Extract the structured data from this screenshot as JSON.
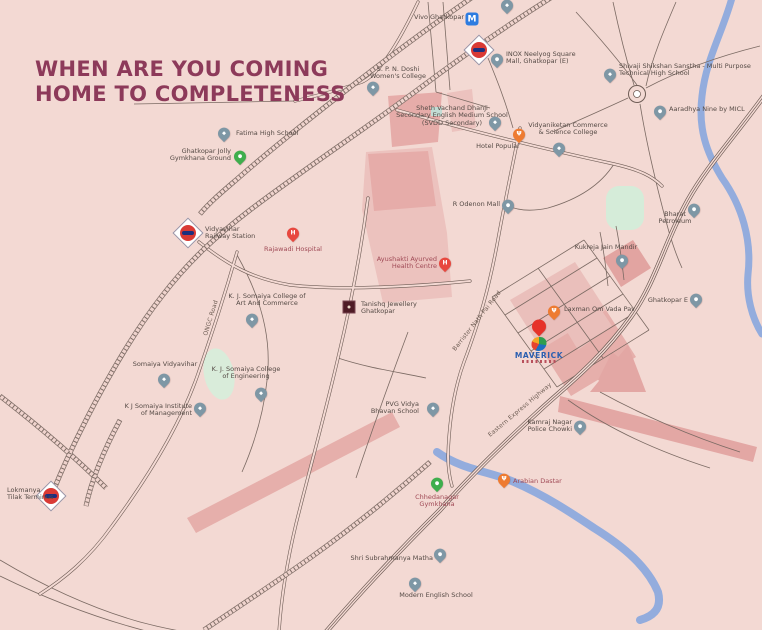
{
  "page": {
    "headline_line1": "WHEN ARE YOU COMING",
    "headline_line2": "HOME TO COMPLETENESS"
  },
  "colors": {
    "background": "#f3d9d3",
    "headline": "#8d3a5a",
    "road": "#6e5c55",
    "river": "#93acdd",
    "pink_block": "#ecc2be",
    "pink_block_dark": "#e6aca9",
    "green_area": "#d6ecd9",
    "pin_slate": "#7e97a5",
    "pin_green": "#3fae4d",
    "pin_orange": "#ee7b31",
    "pin_red": "#e8483f",
    "metro_blue": "#2e7ce0",
    "maverick_blue": "#2a5fb0",
    "label": "#554a45",
    "label_maroon": "#a04a56"
  },
  "map": {
    "glyphs": {
      "hospital": "H",
      "metro": "M"
    },
    "road_labels": [
      {
        "id": "ongc-road",
        "text": "ONGC Road",
        "x": 211,
        "y": 318,
        "rotate": -73
      },
      {
        "id": "barrister-nath-pai-road",
        "text": "Barrister Nath Pai Road",
        "x": 477,
        "y": 321,
        "rotate": -52
      },
      {
        "id": "eastern-express-highway",
        "text": "Eastern Express Highway",
        "x": 520,
        "y": 410,
        "rotate": -40
      }
    ],
    "locations": [
      {
        "id": "jhunjhunwala-college",
        "type": "school",
        "x": 507,
        "y": 14,
        "lines": [
          "Jhunjhunwala College"
        ],
        "label": {
          "x": 470,
          "y": -7,
          "anchor": "c"
        }
      },
      {
        "id": "vivo-ghatkopar-metro",
        "type": "metro",
        "x": 472,
        "y": 19,
        "lines": [
          "Vivo Ghatkopar"
        ],
        "label": {
          "x": 464,
          "y": 14,
          "anchor": "r"
        }
      },
      {
        "id": "ghatkopar-railway-station",
        "type": "rail",
        "x": 479,
        "y": 50,
        "lines": [],
        "label": null
      },
      {
        "id": "inox-neelyog-square-mall",
        "type": "mall",
        "x": 497,
        "y": 68,
        "lines": [
          "INOX Neelyog Square",
          "Mall, Ghatkopar (E)"
        ],
        "label": {
          "x": 506,
          "y": 51,
          "anchor": "l"
        }
      },
      {
        "id": "spn-doshi-womens-college",
        "type": "school",
        "x": 373,
        "y": 96,
        "lines": [
          "S. P. N. Doshi",
          "Women's College"
        ],
        "label": {
          "x": 398,
          "y": 66,
          "anchor": "c"
        }
      },
      {
        "id": "fatima-high-school",
        "type": "school",
        "x": 224,
        "y": 142,
        "lines": [
          "Fatima High School"
        ],
        "label": {
          "x": 236,
          "y": 130,
          "anchor": "l"
        }
      },
      {
        "id": "ghatkopar-jolly-gymkhana-ground",
        "type": "green",
        "x": 240,
        "y": 165,
        "lines": [
          "Ghatkopar Jolly",
          "Gymkhana Ground"
        ],
        "label": {
          "x": 231,
          "y": 148,
          "anchor": "r"
        }
      },
      {
        "id": "vidyavihar-railway-station",
        "type": "rail",
        "x": 188,
        "y": 233,
        "lines": [
          "Vidyavihar",
          "Railway Station"
        ],
        "label": {
          "x": 205,
          "y": 226,
          "anchor": "l"
        }
      },
      {
        "id": "rajawadi-hospital",
        "type": "hospital",
        "x": 293,
        "y": 242,
        "lines": [
          "Rajawadi Hospital"
        ],
        "label": {
          "x": 293,
          "y": 246,
          "anchor": "c",
          "color": "maroon"
        }
      },
      {
        "id": "kj-somaiya-art-commerce",
        "type": "school",
        "x": 252,
        "y": 328,
        "lines": [
          "K. J. Somaiya College of",
          "Art And Commerce"
        ],
        "label": {
          "x": 267,
          "y": 293,
          "anchor": "c"
        }
      },
      {
        "id": "tanishq-jewellery-ghatkopar",
        "type": "tanishq",
        "x": 349,
        "y": 307,
        "lines": [
          "Tanishq Jewellery",
          "Ghatkopar"
        ],
        "label": {
          "x": 361,
          "y": 301,
          "anchor": "l"
        }
      },
      {
        "id": "ayushakti-ayurved-health-centre",
        "type": "hospital",
        "x": 445,
        "y": 272,
        "lines": [
          "Ayushakti Ayurved",
          "Health Centre"
        ],
        "label": {
          "x": 437,
          "y": 256,
          "anchor": "r",
          "color": "maroon"
        }
      },
      {
        "id": "hotel-popular",
        "type": "food",
        "x": 519,
        "y": 143,
        "lines": [
          "Hotel Popular"
        ],
        "label": {
          "x": 498,
          "y": 143,
          "anchor": "c"
        }
      },
      {
        "id": "sheth-svdd-school",
        "type": "school",
        "x": 495,
        "y": 131,
        "lines": [
          "Sheth Vachand Dhanji",
          "Secondary English Medium School",
          "(SVDD Secondary)"
        ],
        "label": {
          "x": 452,
          "y": 105,
          "anchor": "c"
        }
      },
      {
        "id": "vidyaniketan-college",
        "type": "school",
        "x": 559,
        "y": 157,
        "lines": [
          "Vidyaniketan Commerce",
          "& Science College"
        ],
        "label": {
          "x": 568,
          "y": 122,
          "anchor": "c"
        }
      },
      {
        "id": "shivaji-shikshan-sanstha",
        "type": "school",
        "x": 610,
        "y": 83,
        "lines": [
          "Shivaji Shikshan Sanstha - Multi Purpose",
          "Technical High School"
        ],
        "label": {
          "x": 619,
          "y": 63,
          "anchor": "l"
        }
      },
      {
        "id": "aaradhya-nine-by-micl",
        "type": "place",
        "x": 660,
        "y": 120,
        "lines": [
          "Aaradhya Nine by MICL"
        ],
        "label": {
          "x": 669,
          "y": 106,
          "anchor": "l"
        }
      },
      {
        "id": "r-odenon-mall",
        "type": "mall",
        "x": 508,
        "y": 214,
        "lines": [
          "R Odenon Mall"
        ],
        "label": {
          "x": 500,
          "y": 201,
          "anchor": "r"
        }
      },
      {
        "id": "bharat-petroleum",
        "type": "fuel",
        "x": 694,
        "y": 218,
        "lines": [
          "Bharat",
          "Petroleum"
        ],
        "label": {
          "x": 675,
          "y": 211,
          "anchor": "c"
        }
      },
      {
        "id": "kukreja-jain-mandir",
        "type": "place",
        "x": 622,
        "y": 269,
        "lines": [
          "Kukreja Jain Mandir"
        ],
        "label": {
          "x": 606,
          "y": 244,
          "anchor": "c"
        }
      },
      {
        "id": "ghatkopar-e",
        "type": "place",
        "x": 696,
        "y": 308,
        "lines": [
          "Ghatkopar E"
        ],
        "label": {
          "x": 688,
          "y": 297,
          "anchor": "r"
        }
      },
      {
        "id": "laxman-om-vada-pav",
        "type": "food",
        "x": 554,
        "y": 320,
        "lines": [
          "Laxman Om Vada Pav"
        ],
        "label": {
          "x": 564,
          "y": 306,
          "anchor": "l"
        }
      },
      {
        "id": "maverick-site",
        "type": "maverick",
        "x": 539,
        "y": 336,
        "lines": [
          "MAVERICK"
        ],
        "label": null
      },
      {
        "id": "pvg-vidya-bhavan-school",
        "type": "school",
        "x": 433,
        "y": 417,
        "lines": [
          "PVG Vidya",
          "Bhavan School"
        ],
        "label": {
          "x": 419,
          "y": 401,
          "anchor": "r"
        }
      },
      {
        "id": "kamraj-nagar-police-chowki",
        "type": "police",
        "x": 580,
        "y": 435,
        "lines": [
          "Kamraj Nagar",
          "Police Chowki"
        ],
        "label": {
          "x": 572,
          "y": 419,
          "anchor": "r"
        }
      },
      {
        "id": "arabian-dastar",
        "type": "food",
        "x": 504,
        "y": 488,
        "lines": [
          "Arabian Dastar"
        ],
        "label": {
          "x": 513,
          "y": 478,
          "anchor": "l",
          "color": "maroon"
        }
      },
      {
        "id": "chhedanagar-gymkhana",
        "type": "green",
        "x": 437,
        "y": 492,
        "lines": [
          "Chhedanagar",
          "Gymkhana"
        ],
        "label": {
          "x": 437,
          "y": 494,
          "anchor": "c",
          "color": "maroon"
        }
      },
      {
        "id": "shri-subrahmanya-matha",
        "type": "place",
        "x": 440,
        "y": 563,
        "lines": [
          "Shri Subrahmanya Matha"
        ],
        "label": {
          "x": 433,
          "y": 555,
          "anchor": "r"
        }
      },
      {
        "id": "modern-english-school",
        "type": "school",
        "x": 415,
        "y": 592,
        "lines": [
          "Modern English School"
        ],
        "label": {
          "x": 436,
          "y": 592,
          "anchor": "c"
        }
      },
      {
        "id": "somaiya-vidyavihar",
        "type": "school",
        "x": 164,
        "y": 388,
        "lines": [
          "Somaiya Vidyavihar"
        ],
        "label": {
          "x": 165,
          "y": 361,
          "anchor": "c"
        }
      },
      {
        "id": "kj-somaiya-engineering",
        "type": "school",
        "x": 261,
        "y": 402,
        "lines": [
          "K. J. Somaiya College",
          "of Engineering"
        ],
        "label": {
          "x": 246,
          "y": 366,
          "anchor": "c"
        }
      },
      {
        "id": "kj-somaiya-management",
        "type": "school",
        "x": 200,
        "y": 417,
        "lines": [
          "K J Somaiya Institute",
          "of Management"
        ],
        "label": {
          "x": 192,
          "y": 403,
          "anchor": "r"
        }
      },
      {
        "id": "lokmanya-tilak-terminus",
        "type": "rail",
        "x": 51,
        "y": 496,
        "lines": [
          "Lokmanya",
          "Tilak Terminus"
        ],
        "label": {
          "x": 7,
          "y": 487,
          "anchor": "l"
        }
      }
    ]
  }
}
